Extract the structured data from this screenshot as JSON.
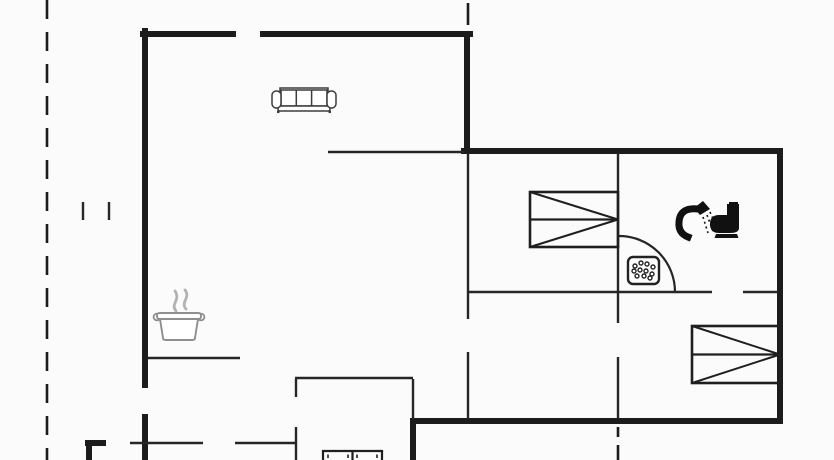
{
  "meta": {
    "canvas": {
      "width": 834,
      "height": 460
    },
    "background": "#fbfbfb",
    "colors": {
      "wall": "#1c1c1c",
      "thin_wall": "#262626",
      "icon_dark": "#111111",
      "icon_gray": "#8f8f8f",
      "steam_gray": "#b2b2b2"
    }
  },
  "boundary": {
    "dash_pattern": [
      19,
      13
    ],
    "stroke_width": 2.6,
    "segments": [
      {
        "name": "property-boundary-left",
        "line": [
          47,
          0,
          47,
          460
        ],
        "dashed": true
      },
      {
        "name": "property-boundary-top-right-dash",
        "line": [
          468,
          3,
          468,
          25
        ],
        "dashed": false
      },
      {
        "name": "property-boundary-bottom-dash-1",
        "line": [
          618,
          427,
          618,
          437
        ],
        "dashed": false
      },
      {
        "name": "property-boundary-bottom-dash-2",
        "line": [
          618,
          445,
          618,
          460
        ],
        "dashed": false
      }
    ]
  },
  "walls": {
    "thick": {
      "stroke_width": 6,
      "segments": [
        {
          "name": "top-wall-left-segment",
          "line": [
            143,
            34,
            233,
            34
          ]
        },
        {
          "name": "top-wall-right-segment",
          "line": [
            263,
            34,
            470,
            34
          ]
        },
        {
          "name": "left-wall-upper",
          "line": [
            145,
            31,
            145,
            385
          ]
        },
        {
          "name": "left-wall-lower",
          "line": [
            145,
            417,
            145,
            460
          ]
        },
        {
          "name": "living-room-right-corner-wall",
          "line": [
            467,
            34,
            467,
            151
          ]
        },
        {
          "name": "bedroom-top-wall",
          "line": [
            464,
            151,
            780,
            151
          ]
        },
        {
          "name": "right-wall",
          "line": [
            780,
            151,
            780,
            421
          ]
        },
        {
          "name": "bottom-wall",
          "line": [
            413,
            421,
            780,
            421
          ]
        },
        {
          "name": "extension-right-wall-thick",
          "line": [
            413,
            421,
            413,
            460
          ]
        },
        {
          "name": "porch-corner-horizontal",
          "line": [
            88,
            443,
            103,
            443
          ]
        },
        {
          "name": "porch-corner-vertical",
          "line": [
            89,
            443,
            89,
            460
          ]
        }
      ]
    },
    "thin": {
      "stroke_width": 2.4,
      "segments": [
        {
          "name": "living-bedroom-divider",
          "line": [
            328,
            152,
            464,
            152
          ]
        },
        {
          "name": "hall-left-wall-upper",
          "line": [
            468,
            153,
            468,
            319
          ]
        },
        {
          "name": "hall-left-wall-lower",
          "line": [
            468,
            352,
            468,
            419
          ]
        },
        {
          "name": "bedroom1-bath-wall-upper",
          "line": [
            618,
            153,
            618,
            323
          ]
        },
        {
          "name": "bedroom1-bath-wall-lower",
          "line": [
            618,
            357,
            618,
            419
          ]
        },
        {
          "name": "bath-bedroom2-wall-left",
          "line": [
            469,
            292,
            712,
            292
          ]
        },
        {
          "name": "bath-bedroom2-wall-right",
          "line": [
            743,
            292,
            778,
            292
          ]
        },
        {
          "name": "kitchen-counter-wall",
          "line": [
            148,
            358,
            240,
            358
          ]
        },
        {
          "name": "entrance-wall-left",
          "line": [
            130,
            443,
            203,
            443
          ]
        },
        {
          "name": "entrance-wall-right",
          "line": [
            235,
            443,
            297,
            443
          ]
        },
        {
          "name": "extension-top-wall",
          "line": [
            295,
            378,
            413,
            378
          ]
        },
        {
          "name": "extension-left-wall-upper",
          "line": [
            296,
            379,
            296,
            397
          ]
        },
        {
          "name": "extension-left-wall-lower",
          "line": [
            296,
            427,
            296,
            460
          ]
        },
        {
          "name": "extension-right-wall-thin",
          "line": [
            413,
            379,
            413,
            419
          ]
        },
        {
          "name": "gate-marker-left",
          "line": [
            83,
            202,
            83,
            220
          ]
        },
        {
          "name": "gate-marker-right",
          "line": [
            109,
            202,
            109,
            220
          ]
        }
      ]
    }
  },
  "doors": [
    {
      "name": "bathroom-door-swing-arc",
      "hinge": [
        619,
        292
      ],
      "radius": 56,
      "start": [
        619,
        236
      ],
      "end": [
        675,
        292
      ],
      "stroke_width": 2.2
    }
  ],
  "furniture": [
    {
      "name": "sofa-icon",
      "type": "sofa",
      "x": 272,
      "y": 86,
      "w": 64,
      "h": 26
    },
    {
      "name": "cooking-pot-icon",
      "type": "pot",
      "x": 155,
      "y": 288,
      "w": 48,
      "h": 52
    },
    {
      "name": "bed-icon-1",
      "type": "bed",
      "x": 530,
      "y": 192,
      "w": 88,
      "h": 55
    },
    {
      "name": "bed-icon-2",
      "type": "bed",
      "x": 692,
      "y": 326,
      "w": 88,
      "h": 57
    },
    {
      "name": "shower-icon",
      "type": "shower",
      "x": 673,
      "y": 200,
      "w": 40,
      "h": 40
    },
    {
      "name": "toilet-icon",
      "type": "toilet",
      "x": 710,
      "y": 202,
      "w": 33,
      "h": 36
    },
    {
      "name": "shower-drain-icon",
      "type": "drain",
      "x": 628,
      "y": 257,
      "w": 31,
      "h": 27
    },
    {
      "name": "partial-bed-icon",
      "type": "partialbed",
      "x": 321,
      "y": 449,
      "w": 63,
      "h": 11
    }
  ]
}
